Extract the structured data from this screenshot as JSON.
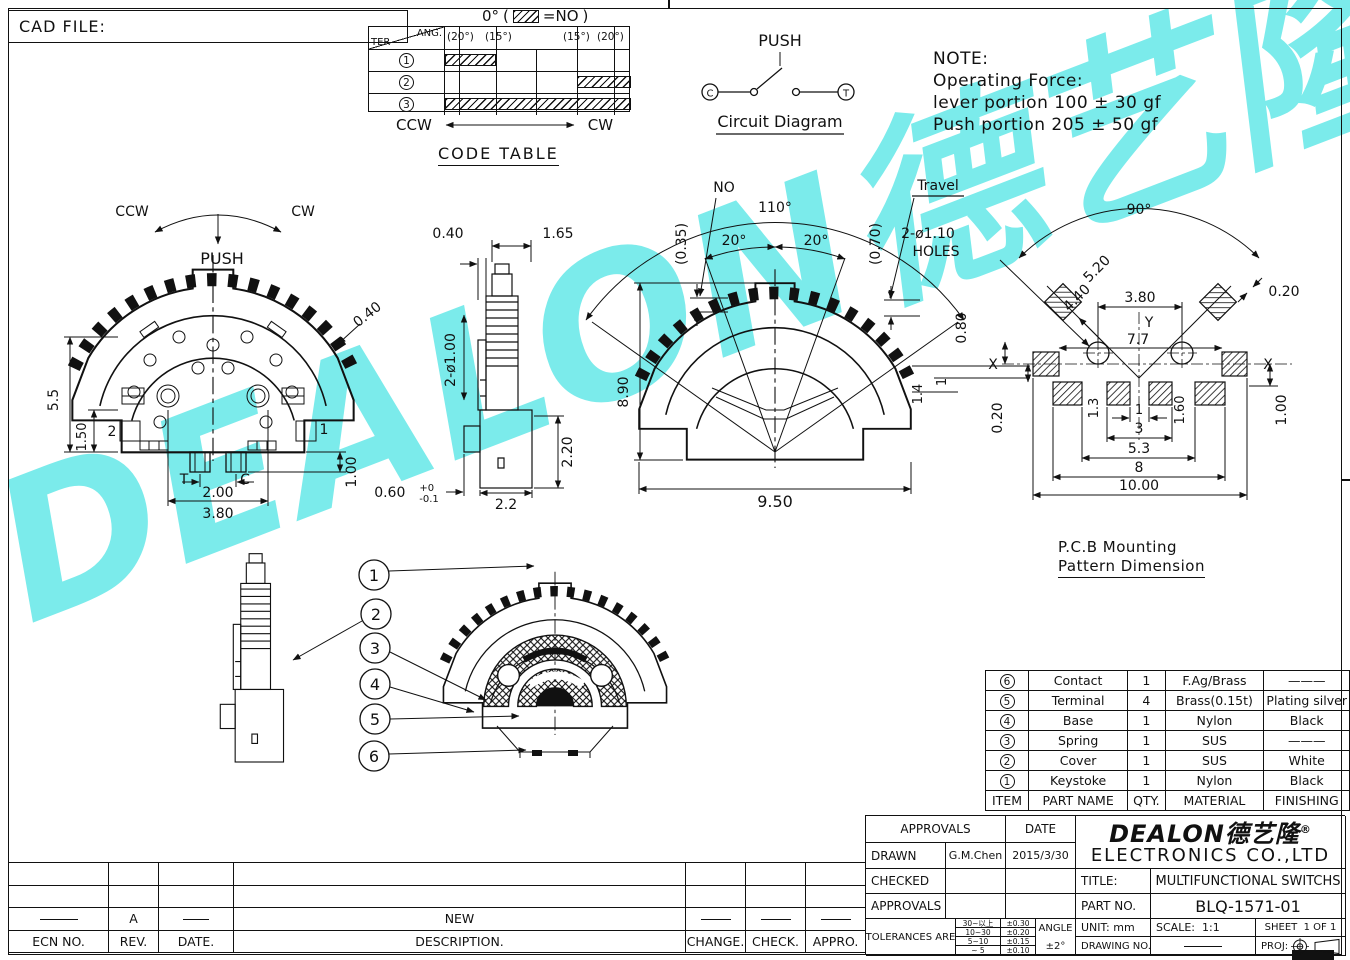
{
  "watermark": {
    "text": "DEALON",
    "cn": "德艺隆",
    "reg": "®",
    "color": "#7bebeb"
  },
  "cad_file": {
    "label": "CAD FILE:"
  },
  "code_table": {
    "zero": "0°",
    "eq": "=NO",
    "ang": "ANG.",
    "ter": "TER",
    "col1": "(20°)",
    "col2": "(15°)",
    "col3": "(15°)",
    "col4": "(20°)",
    "r1": "1",
    "r2": "2",
    "r3": "3",
    "ccw": "CCW",
    "cw": "CW",
    "title": "CODE TABLE"
  },
  "circuit": {
    "push": "PUSH",
    "c": "C",
    "t": "T",
    "title": "Circuit Diagram"
  },
  "note": {
    "l1": "NOTE:",
    "l2": "Operating Force:",
    "l3": "lever portion 100 ± 30 gf",
    "l4": "Push portion 205 ± 50 gf"
  },
  "views": {
    "front": {
      "ccw": "CCW",
      "cw": "CW",
      "push": "PUSH",
      "d_h": "5.5",
      "d_b": "1.50",
      "lbl2": "2",
      "d_tooth": "0.40",
      "lbl1": "1",
      "d_pin": "1.00",
      "t": "T",
      "c": "C",
      "d_pitch": "2.00",
      "d_span": "3.80"
    },
    "side": {
      "d1": "0.40",
      "d2": "1.65",
      "d3": "2-ø1.00",
      "d4": "2.20",
      "d5": "0.60",
      "d5a": "+0",
      "d5b": "-0.1",
      "d6": "2.2"
    },
    "travel": {
      "no_off": "(0.35)",
      "no": "NO",
      "a1": "110°",
      "a2": "20°",
      "a3": "20°",
      "t_off": "(0.70)",
      "travel": "Travel",
      "d_h": "8.90",
      "d_w": "9.50"
    },
    "pcb": {
      "a": "90°",
      "holes1": "2-ø1.10",
      "holes2": "HOLES",
      "r1": "5.20",
      "r2": "4.40",
      "d1": "3.80",
      "d2": "0.20",
      "d3": "0.80",
      "x1": "X",
      "x2": "X",
      "y": "Y",
      "d4": "7.7",
      "d5": "1.4",
      "d6": "1",
      "d7": "1.3",
      "d8": "1.60",
      "d9": "0.20",
      "s1": "1",
      "s2": "3",
      "s3": "5.3",
      "s4": "8",
      "s5": "10.00",
      "d10": "1.00",
      "cap1": "P.C.B Mounting",
      "cap2": "Pattern Dimension"
    },
    "section": {
      "c1": "1",
      "c2": "2",
      "c3": "3",
      "c4": "4",
      "c5": "5",
      "c6": "6"
    }
  },
  "parts": {
    "headers": [
      "ITEM",
      "PART NAME",
      "QTY.",
      "MATERIAL",
      "FINISHING"
    ],
    "rows": [
      [
        "6",
        "Contact",
        "1",
        "F.Ag/Brass",
        "———"
      ],
      [
        "5",
        "Terminal",
        "4",
        "Brass(0.15t)",
        "Plating silver"
      ],
      [
        "4",
        "Base",
        "1",
        "Nylon",
        "Black"
      ],
      [
        "3",
        "Spring",
        "1",
        "SUS",
        "———"
      ],
      [
        "2",
        "Cover",
        "1",
        "SUS",
        "White"
      ],
      [
        "1",
        "Keystoke",
        "1",
        "Nylon",
        "Black"
      ]
    ]
  },
  "title_block": {
    "approvals": "APPROVALS",
    "date": "DATE",
    "drawn": "DRAWN",
    "drawn_by": "G.M.Chen",
    "drawn_date": "2015/3/30",
    "checked": "CHECKED",
    "approvals2": "APPROVALS",
    "tol_label": "TOLERANCES ARE",
    "t1a": "30~以上",
    "t1b": "±0.30",
    "t2a": "10~30",
    "t2b": "±0.20",
    "t3a": "5~10",
    "t3b": "±0.15",
    "t4a": "~ 5",
    "t4b": "±0.10",
    "angle": "ANGLE",
    "angle_v": "±2°",
    "logo": "DEALON",
    "logo_cn": "德艺隆",
    "reg": "®",
    "company": "ELECTRONICS CO.,LTD",
    "title_l": "TITLE:",
    "title_v": "MULTIFUNCTIONAL SWITCHS",
    "part_l": "PART NO.",
    "part_v": "BLQ-1571-01",
    "unit_l": "UNIT:",
    "unit_v": "mm",
    "scale_l": "SCALE:",
    "scale_v": "1:1",
    "sheet_l": "SHEET",
    "sheet_v": "1 OF 1",
    "drawing_l": "DRAWING NO.",
    "proj_l": "PROJ:"
  },
  "revisions": {
    "h1": "ECN NO.",
    "h2": "REV.",
    "h3": "DATE.",
    "h4": "DESCRIPTION.",
    "h5": "CHANGE.",
    "h6": "CHECK.",
    "h7": "APPRO.",
    "rev": "A",
    "desc": "NEW"
  }
}
